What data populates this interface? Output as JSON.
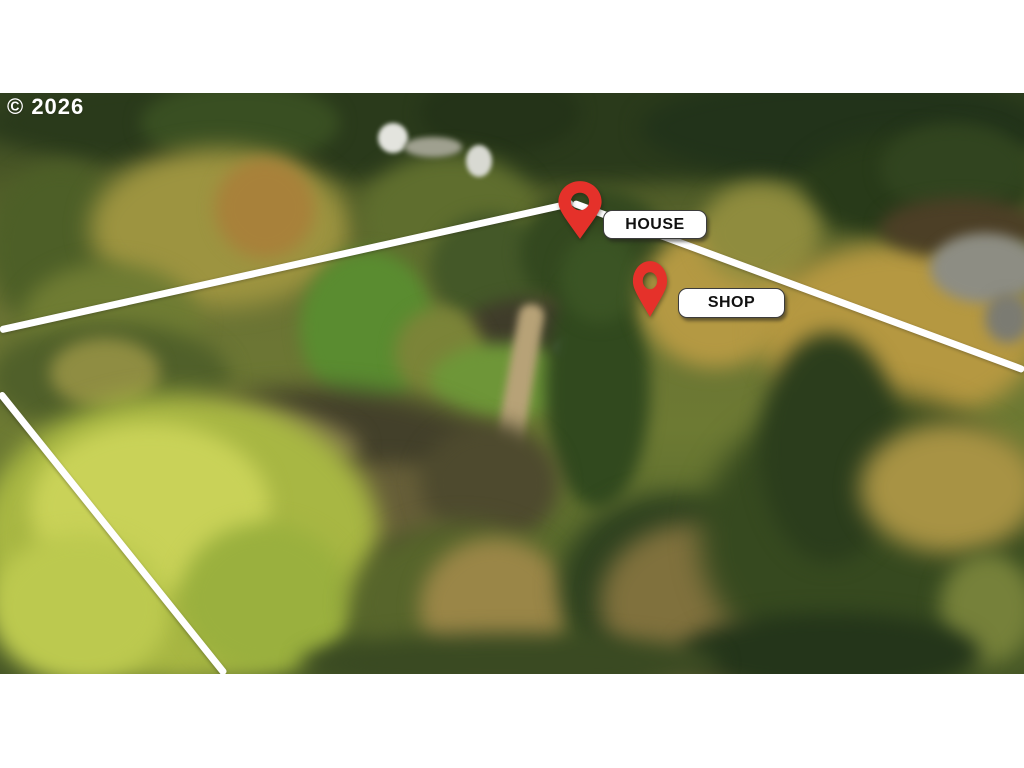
{
  "watermark": {
    "text": "© 2026",
    "color": "#ffffff"
  },
  "markers": [
    {
      "id": "house",
      "label": "HOUSE",
      "pin": {
        "x": 556,
        "y": 87,
        "w": 48,
        "h": 60,
        "color": "#e5312a"
      },
      "label_box": {
        "x": 603,
        "y": 117,
        "w": 102,
        "h": 27
      }
    },
    {
      "id": "shop",
      "label": "SHOP",
      "pin": {
        "x": 631,
        "y": 167,
        "w": 38,
        "h": 58,
        "color": "#e5312a"
      },
      "label_box": {
        "x": 678,
        "y": 195,
        "w": 105,
        "h": 28
      }
    }
  ],
  "boundary_lines": {
    "color": "#ffffff",
    "thickness": 7,
    "segments": [
      {
        "x1": 0,
        "y1": 237,
        "x2": 573,
        "y2": 110
      },
      {
        "x1": 573,
        "y1": 110,
        "x2": 1024,
        "y2": 277
      },
      {
        "x1": 0,
        "y1": 300,
        "x2": 225,
        "y2": 581
      }
    ]
  },
  "scene": {
    "description": "Aerial drone photo of wooded rural property, autumn colors, dirt driveway, gray road top right, white rooftop glimpses upper left",
    "palette": {
      "dark_conifer": "#2a3a1b",
      "olive_canopy": "#9d9440",
      "golden_tree": "#b59841",
      "bright_lime": "#c9d258",
      "dirt_path": "#b7a277",
      "road_gray": "#8d8d83",
      "ground_shadow": "#43402a",
      "roof_white": "#e3e4de",
      "shop_roof": "#76828c"
    }
  },
  "photo_blobs": [
    {
      "x": -20,
      "y": -30,
      "w": 1100,
      "h": 120,
      "c": "#2a3a1b",
      "b": 10
    },
    {
      "x": 140,
      "y": -10,
      "w": 200,
      "h": 80,
      "c": "#394f22",
      "b": 8
    },
    {
      "x": 420,
      "y": -20,
      "w": 160,
      "h": 80,
      "c": "#243318",
      "b": 8
    },
    {
      "x": 640,
      "y": -15,
      "w": 400,
      "h": 100,
      "c": "#22331a",
      "b": 10
    },
    {
      "x": 800,
      "y": 40,
      "w": 230,
      "h": 110,
      "c": "#283a19",
      "b": 10
    },
    {
      "x": 880,
      "y": 30,
      "w": 150,
      "h": 90,
      "c": "#31441f",
      "b": 8
    },
    {
      "x": -10,
      "y": 70,
      "w": 140,
      "h": 170,
      "c": "#4d5f27",
      "b": 10
    },
    {
      "x": 90,
      "y": 55,
      "w": 260,
      "h": 160,
      "c": "#9d9440",
      "b": 12
    },
    {
      "x": 215,
      "y": 65,
      "w": 100,
      "h": 100,
      "c": "#a8813a",
      "b": 8
    },
    {
      "x": 20,
      "y": 170,
      "w": 180,
      "h": 120,
      "c": "#6f7c33",
      "b": 10
    },
    {
      "x": 360,
      "y": 60,
      "w": 180,
      "h": 130,
      "c": "#5f6e2e",
      "b": 10
    },
    {
      "x": 378,
      "y": 30,
      "w": 30,
      "h": 30,
      "c": "#e3e4de",
      "b": 2
    },
    {
      "x": 466,
      "y": 52,
      "w": 26,
      "h": 32,
      "c": "#d8d9d2",
      "b": 2
    },
    {
      "x": 404,
      "y": 44,
      "w": 58,
      "h": 20,
      "c": "#9fa08f",
      "b": 3
    },
    {
      "x": 300,
      "y": 157,
      "w": 135,
      "h": 155,
      "c": "#5a8c30",
      "b": 8
    },
    {
      "x": 430,
      "y": 120,
      "w": 120,
      "h": 110,
      "c": "#445828",
      "b": 8
    },
    {
      "x": 520,
      "y": 95,
      "w": 150,
      "h": 130,
      "c": "#33481f",
      "b": 8
    },
    {
      "x": 460,
      "y": 205,
      "w": 140,
      "h": 70,
      "c": "#3f3c2a",
      "b": 8
    },
    {
      "x": 395,
      "y": 215,
      "w": 90,
      "h": 90,
      "c": "#7b8438",
      "b": 8
    },
    {
      "x": 430,
      "y": 250,
      "w": 150,
      "h": 75,
      "c": "#6e9638",
      "b": 8
    },
    {
      "x": 505,
      "y": 210,
      "w": 26,
      "h": 180,
      "c": "#b7a277",
      "b": 4,
      "r": 10,
      "rad": "12px"
    },
    {
      "x": 555,
      "y": 242,
      "w": 48,
      "h": 26,
      "c": "#76828c",
      "b": 3
    },
    {
      "x": 545,
      "y": 175,
      "w": 105,
      "h": 240,
      "c": "#31491e",
      "b": 8
    },
    {
      "x": 560,
      "y": 140,
      "w": 80,
      "h": 90,
      "c": "#3b5424",
      "b": 8
    },
    {
      "x": 640,
      "y": 135,
      "w": 150,
      "h": 140,
      "c": "#b49943",
      "b": 10
    },
    {
      "x": 700,
      "y": 90,
      "w": 120,
      "h": 100,
      "c": "#8f8c3e",
      "b": 10
    },
    {
      "x": 760,
      "y": 150,
      "w": 280,
      "h": 180,
      "c": "#b59841",
      "b": 12
    },
    {
      "x": 880,
      "y": 105,
      "w": 160,
      "h": 60,
      "c": "#4c3f26",
      "b": 8
    },
    {
      "x": 930,
      "y": 140,
      "w": 110,
      "h": 70,
      "c": "#8d8d83",
      "b": 6
    },
    {
      "x": 985,
      "y": 200,
      "w": 45,
      "h": 50,
      "c": "#7b7b72",
      "b": 6
    },
    {
      "x": -10,
      "y": 230,
      "w": 240,
      "h": 110,
      "c": "#50602a",
      "b": 10
    },
    {
      "x": 50,
      "y": 245,
      "w": 110,
      "h": 70,
      "c": "#8f8d42",
      "b": 8
    },
    {
      "x": 95,
      "y": 295,
      "w": 430,
      "h": 190,
      "c": "#43402a",
      "b": 12
    },
    {
      "x": 150,
      "y": 320,
      "w": 210,
      "h": 70,
      "c": "#7b7148",
      "b": 10
    },
    {
      "x": 290,
      "y": 370,
      "w": 190,
      "h": 80,
      "c": "#665e38",
      "b": 10
    },
    {
      "x": 420,
      "y": 330,
      "w": 140,
      "h": 120,
      "c": "#4e4a2e",
      "b": 10
    },
    {
      "x": -20,
      "y": 300,
      "w": 400,
      "h": 290,
      "c": "#a8b743",
      "b": 12
    },
    {
      "x": 30,
      "y": 330,
      "w": 240,
      "h": 170,
      "c": "#c9d258",
      "b": 10
    },
    {
      "x": -10,
      "y": 440,
      "w": 180,
      "h": 150,
      "c": "#bcc94f",
      "b": 10
    },
    {
      "x": 180,
      "y": 430,
      "w": 170,
      "h": 150,
      "c": "#9ab03e",
      "b": 10
    },
    {
      "x": 350,
      "y": 430,
      "w": 220,
      "h": 160,
      "c": "#57652b",
      "b": 12
    },
    {
      "x": 420,
      "y": 445,
      "w": 150,
      "h": 140,
      "c": "#9a8647",
      "b": 10
    },
    {
      "x": 560,
      "y": 400,
      "w": 230,
      "h": 190,
      "c": "#2e411f",
      "b": 12
    },
    {
      "x": 600,
      "y": 430,
      "w": 190,
      "h": 160,
      "c": "#80713d",
      "b": 12
    },
    {
      "x": 700,
      "y": 300,
      "w": 340,
      "h": 290,
      "c": "#36491f",
      "b": 14
    },
    {
      "x": 760,
      "y": 240,
      "w": 140,
      "h": 230,
      "c": "#2b3d1c",
      "b": 10
    },
    {
      "x": 860,
      "y": 330,
      "w": 180,
      "h": 130,
      "c": "#a89344",
      "b": 12
    },
    {
      "x": 940,
      "y": 460,
      "w": 95,
      "h": 110,
      "c": "#76813a",
      "b": 10
    },
    {
      "x": 680,
      "y": 520,
      "w": 300,
      "h": 80,
      "c": "#24351a",
      "b": 10
    },
    {
      "x": 300,
      "y": 540,
      "w": 420,
      "h": 60,
      "c": "#3a4a22",
      "b": 10
    }
  ]
}
